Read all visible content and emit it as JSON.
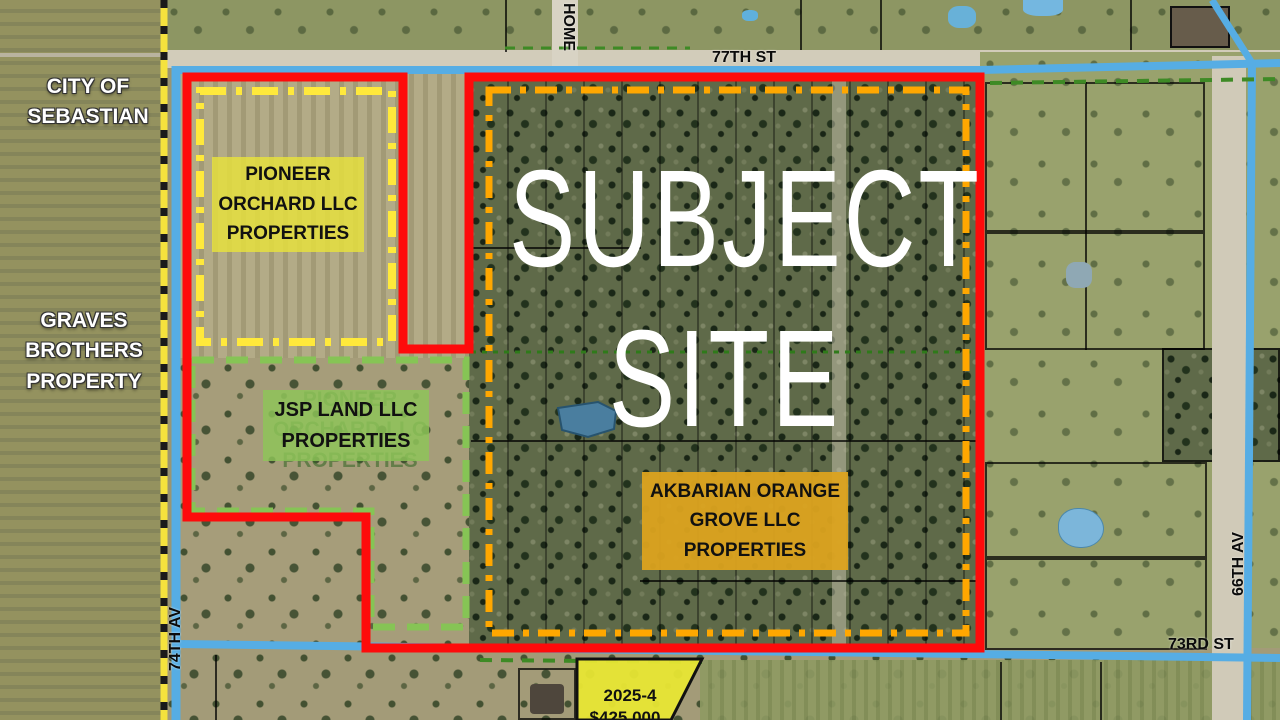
{
  "labels": {
    "city": {
      "line1": "CITY OF",
      "line2": "SEBASTIAN"
    },
    "graves": {
      "line1": "GRAVES",
      "line2": "BROTHERS",
      "line3": "PROPERTY"
    },
    "pioneer": {
      "line1": "PIONEER",
      "line2": "ORCHARD LLC",
      "line3": "PROPERTIES"
    },
    "pioneer_ghost": {
      "line1": "PIONEER",
      "line2": "ORCHARD LLC",
      "line3": "PROPERTIES"
    },
    "jsp": {
      "line1": "JSP LAND LLC",
      "line2": "PROPERTIES"
    },
    "subject": {
      "line1": "SUBJECT",
      "line2": "SITE"
    },
    "akbarian": {
      "line1": "AKBARIAN ORANGE",
      "line2": "GROVE LLC",
      "line3": "PROPERTIES"
    }
  },
  "streets": {
    "st77": "77TH ST",
    "st73": "73RD ST",
    "av74": "74TH AV",
    "av66": "66TH AV",
    "home": "HOME"
  },
  "listing": {
    "case_number": "2025-4",
    "price": "$425,000"
  },
  "colors": {
    "subject_boundary_red": "#FE0B0B",
    "inner_dash_orange": "#FFA700",
    "pioneer_dash_yellow": "#FFE93B",
    "jsp_dash_green": "#86C455",
    "city_limit_yellow": "#F5E23D",
    "road_blue": "#56ADE4",
    "label_box_yellow": "#E8E23C",
    "label_box_green": "#8EC658",
    "label_box_orange": "#DCA31F"
  }
}
